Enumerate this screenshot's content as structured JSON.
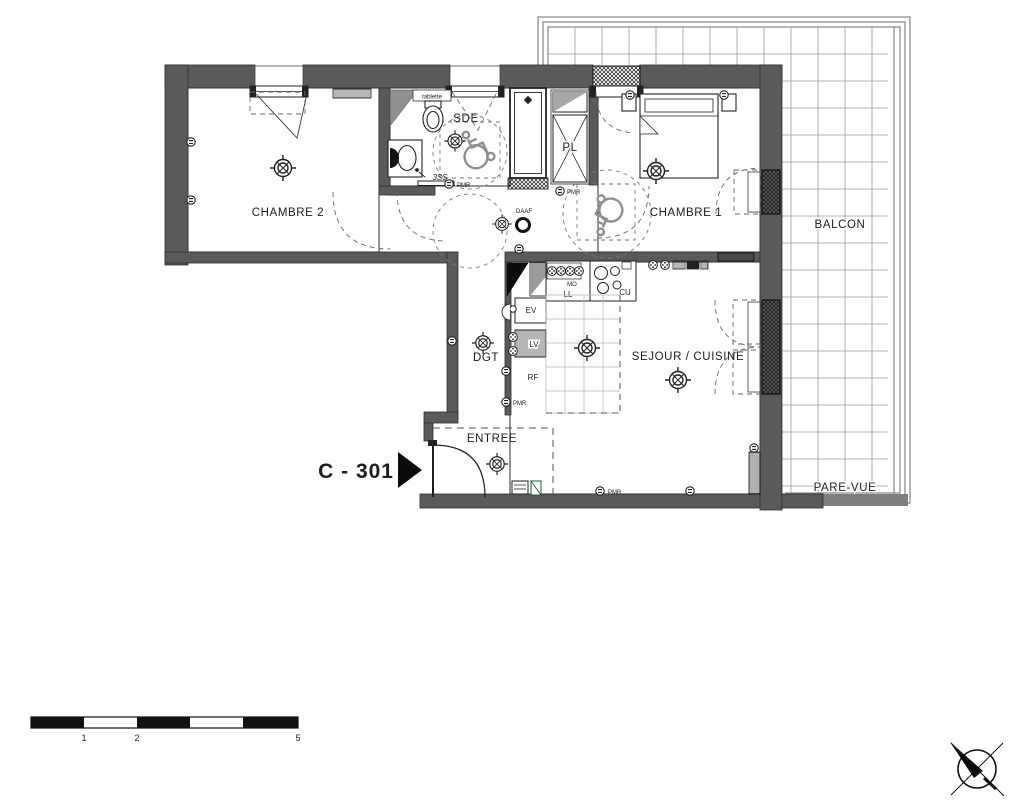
{
  "plan": {
    "unit_label": "C - 301",
    "rooms": {
      "chambre2": "CHAMBRE 2",
      "chambre1": "CHAMBRE 1",
      "sde": "SDE",
      "pl": "PL",
      "dgt": "DGT",
      "sejour_cuisine": "SEJOUR / CUISINE",
      "entree": "ENTREE",
      "balcon": "BALCON",
      "pare_vue": "PARE-VUE"
    },
    "equipment": {
      "ev": "EV",
      "lv": "LV",
      "rf": "RF",
      "mo": "MO",
      "ll": "LL",
      "cu": "CU",
      "tablette": "tablette",
      "seche_serviettes": "3SS",
      "daaf": "DAAF",
      "pmr": "PMR"
    },
    "scale_bar": {
      "ticks": [
        "1",
        "2",
        "5"
      ]
    },
    "colors": {
      "wall": "#5a5a5a",
      "line": "#1c1c1c",
      "grid": "#9a9a9a",
      "background": "#ffffff"
    }
  }
}
